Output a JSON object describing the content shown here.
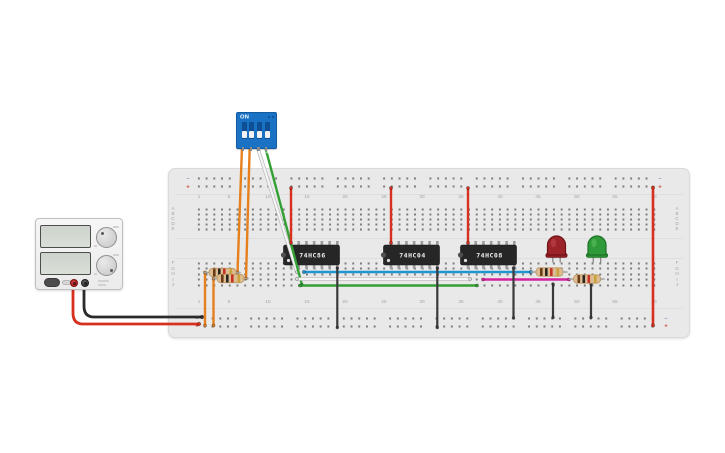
{
  "scene": {
    "description": "Breadboard logic-gate circuit with DIP switch, 74HC86 / 74HC04 / 74HC08 ICs, two LEDs and a bench power supply",
    "background": "#ffffff"
  },
  "power_supply": {
    "display_count": 2,
    "knob_count": 2,
    "terminals": [
      "positive",
      "negative"
    ],
    "body_color": "#f2f2f2"
  },
  "dip_switch": {
    "label": "ON",
    "switch_labels": [
      "1",
      "2",
      "3",
      "4"
    ],
    "states": [
      "off",
      "off",
      "off",
      "off"
    ],
    "body_color": "#1a72c4"
  },
  "breadboard": {
    "row_labels_top": [
      "A",
      "B",
      "C",
      "D",
      "E"
    ],
    "row_labels_bottom": [
      "F",
      "G",
      "H",
      "I",
      "J"
    ],
    "column_numbers": [
      1,
      5,
      10,
      15,
      20,
      25,
      30,
      35,
      40,
      45,
      50,
      55,
      60
    ],
    "rail_markers": {
      "minus": "−",
      "plus": "+"
    },
    "board_color": "#e9e9e9",
    "hole_color": "#7b7b7b",
    "label_color": "#a3a3a3",
    "marker_minus_color": "#7d95b5",
    "marker_plus_color": "#c63a2e"
  },
  "ics": [
    {
      "label": "74HC86",
      "pin_x": 291
    },
    {
      "label": "74HC04",
      "pin_x": 391
    },
    {
      "label": "74HC08",
      "pin_x": 468
    }
  ],
  "ic_style": {
    "body_fill": "#262626",
    "pin_fill": "#9c9c9c",
    "label_color": "#f0f0f0"
  },
  "leds": [
    {
      "name": "led-red",
      "color_name": "red",
      "fill": "#9b2329",
      "rim": "#6f1317",
      "highlight": "#c24a50",
      "cx": 556.5
    },
    {
      "name": "led-green",
      "color_name": "green",
      "fill": "#2f9a39",
      "rim": "#1d7026",
      "highlight": "#5cc261",
      "cx": 597
    }
  ],
  "resistors": [
    {
      "name": "resistor-1",
      "y": 272.5,
      "x1": 204.5,
      "x2": 240,
      "body_x": 209,
      "body_w": 27
    },
    {
      "name": "resistor-2",
      "y": 278.5,
      "x1": 213.5,
      "x2": 248,
      "body_x": 217,
      "body_w": 27
    },
    {
      "name": "resistor-3",
      "y": 272,
      "x1": 531.5,
      "x2": 567,
      "body_x": 536,
      "body_w": 27
    },
    {
      "name": "resistor-4",
      "y": 279,
      "x1": 569.5,
      "x2": 604,
      "body_x": 573.5,
      "body_w": 27
    }
  ],
  "resistor_style": {
    "body_fill": "#dcbd92",
    "body_stroke": "#bb9560",
    "band_colors": [
      "#6b3a17",
      "#2a2420",
      "#c93026",
      "#c9a23b"
    ],
    "lead_color": "#9f9f9f"
  },
  "wires": [
    {
      "name": "psu-negative-wire",
      "color": "#2b2b2b",
      "width": 2.8,
      "d": "M84,284 L84,306 Q84,317 94,317 L202,317"
    },
    {
      "name": "psu-positive-wire",
      "color": "#d8301f",
      "width": 2.8,
      "d": "M73,284 L73,313 Q73,324 83,324 L199,324"
    },
    {
      "name": "rail-jumper-orange-1",
      "color": "#e5801c",
      "width": 2.4,
      "d": "M205,272.5 L205,325.5"
    },
    {
      "name": "rail-jumper-orange-2",
      "color": "#e5801c",
      "width": 2.4,
      "d": "M213.5,278.5 L213.5,325.5"
    },
    {
      "name": "dip-wire-1-orange",
      "color": "#e5801c",
      "width": 2.4,
      "d": "M242,147 L237.5,272.5"
    },
    {
      "name": "dip-wire-2-orange",
      "color": "#e5801c",
      "width": 2.4,
      "d": "M249.7,147 L246,278.5"
    },
    {
      "name": "dip-wire-3-white",
      "color": "#f4f4f4",
      "outline": "#b8b8b8",
      "width": 2.2,
      "d": "M257.4,147 L297,272"
    },
    {
      "name": "dip-wire-4-green",
      "color": "#33a033",
      "width": 2.4,
      "d": "M265.2,147 L302,285"
    },
    {
      "name": "signal-blue",
      "color": "#2095d2",
      "width": 2.6,
      "d": "M304,272 L531,272"
    },
    {
      "name": "signal-white",
      "color": "#f4f4f4",
      "outline": "#b8b8b8",
      "width": 2.2,
      "d": "M297,279 L470,279"
    },
    {
      "name": "signal-green",
      "color": "#33a033",
      "width": 2.4,
      "d": "M300,285.5 L477,285.5"
    },
    {
      "name": "signal-magenta",
      "color": "#d4239d",
      "width": 2.4,
      "d": "M483,279.5 L569,279.5"
    },
    {
      "name": "vcc-wire-74hc86",
      "color": "#d8301f",
      "width": 2.4,
      "d": "M291,188 L291,243"
    },
    {
      "name": "vcc-wire-74hc04",
      "color": "#d8301f",
      "width": 2.4,
      "d": "M391,188 L391,243"
    },
    {
      "name": "vcc-wire-74hc08",
      "color": "#d8301f",
      "width": 2.4,
      "d": "M468,188 L468,243"
    },
    {
      "name": "rail-jumper-red-right",
      "color": "#d8301f",
      "width": 2.6,
      "d": "M653,187.5 L653,325.5"
    },
    {
      "name": "gnd-wire-74hc86",
      "color": "#3a3a3a",
      "width": 2.2,
      "d": "M337.3,268 L337.3,327.5"
    },
    {
      "name": "gnd-wire-74hc04",
      "color": "#3a3a3a",
      "width": 2.2,
      "d": "M437.3,268 L437.3,327.5"
    },
    {
      "name": "gnd-wire-74hc08",
      "color": "#3a3a3a",
      "width": 2.2,
      "d": "M513.5,268 L513.5,318"
    },
    {
      "name": "gnd-wire-led-red",
      "color": "#3a3a3a",
      "width": 2.2,
      "d": "M553,284 L553,317.5"
    },
    {
      "name": "gnd-wire-led-green",
      "color": "#3a3a3a",
      "width": 2.2,
      "d": "M591,284 L591,317.5"
    }
  ]
}
